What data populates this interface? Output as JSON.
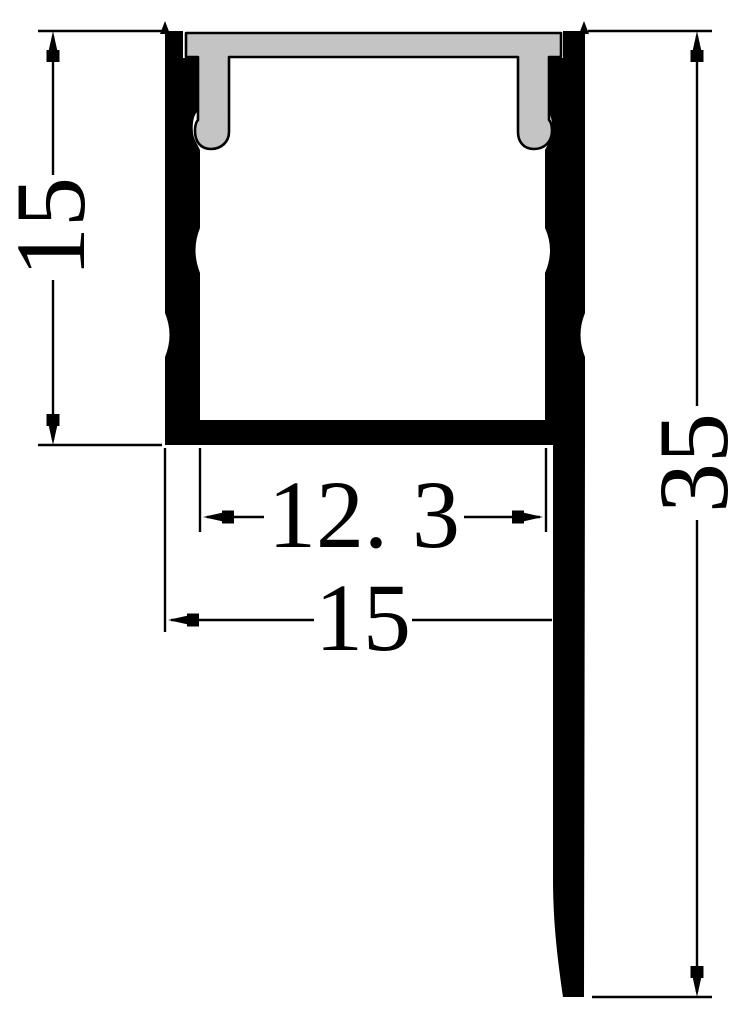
{
  "drawing": {
    "dimensions": {
      "channel_height": "15",
      "inner_width": "12. 3",
      "outer_width": "15",
      "overall_height": "35"
    },
    "colors": {
      "outline": "#000000",
      "diffuser_fill": "#c4c4c4",
      "background": "#ffffff"
    }
  }
}
